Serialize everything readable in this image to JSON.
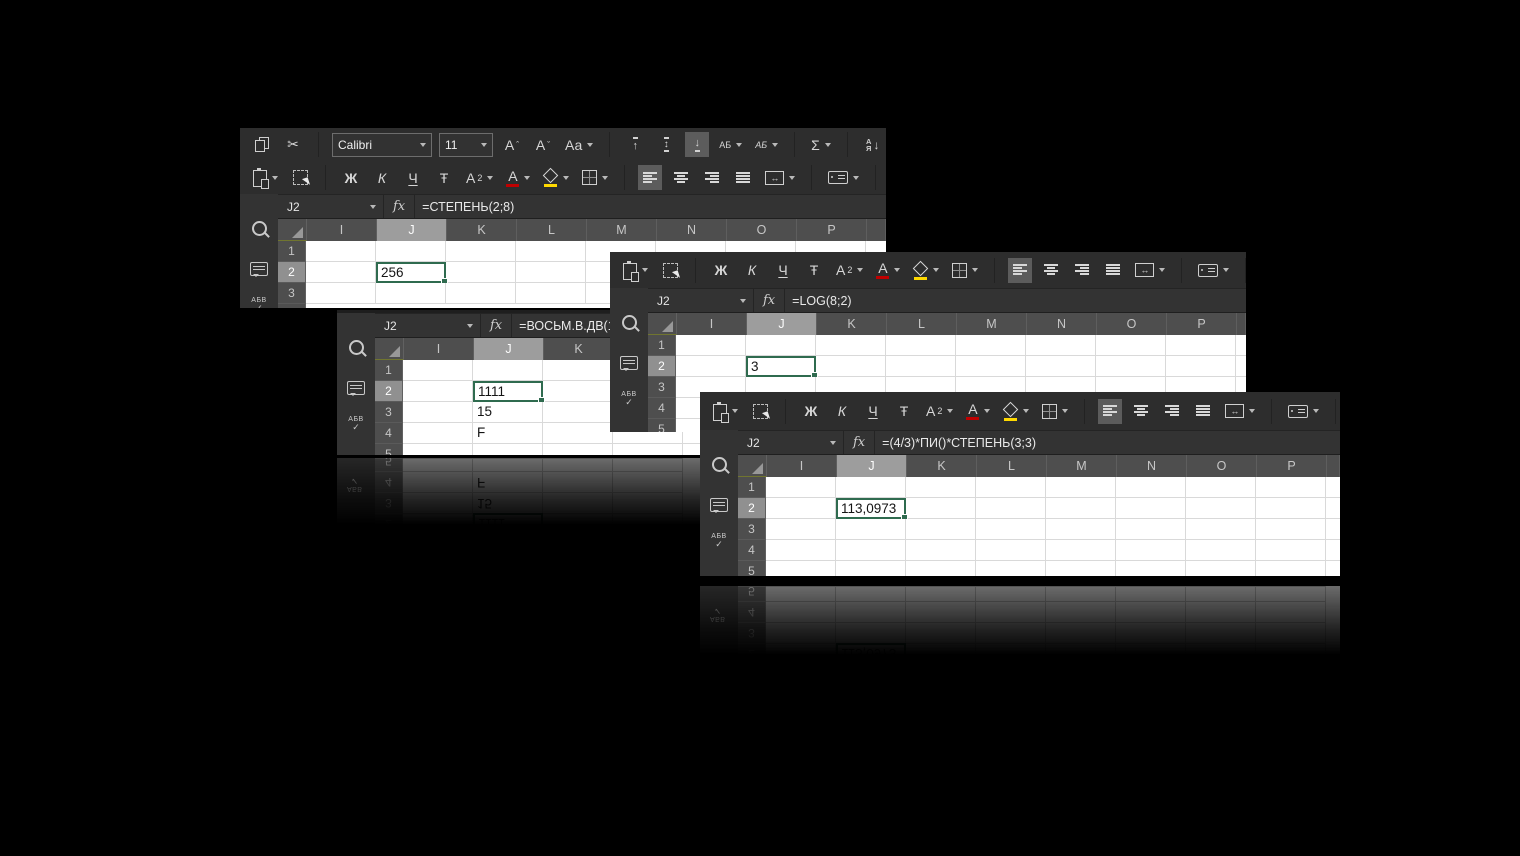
{
  "page": {
    "background": "#000000"
  },
  "colors": {
    "selection_green": "#2f6b4f",
    "font_color_underbar": "#c00000",
    "fill_color_underbar": "#ffd900"
  },
  "sidebar": {
    "spell_label": "АБВ",
    "check_glyph": "✓"
  },
  "formula_bar": {
    "fx": "fx"
  },
  "ribbon": {
    "font_name": "Calibri",
    "font_size": "11",
    "number_format": "Общ",
    "cut_glyph": "✂",
    "bold": "Ж",
    "italic": "К",
    "underline": "Ч",
    "strikethrough": "Ŧ",
    "letter_a": "А",
    "sub_two": "2",
    "case_label": "Аа",
    "caret_up": "ˆ",
    "caret_down": "ˇ",
    "arrow_up": "↑",
    "arrow_down": "↓",
    "arrow_updown": "↕",
    "arrow_leftright": "↔",
    "rotate_label": "АБ",
    "pencil_label": "АБ",
    "sum_glyph": "Σ",
    "percent": "%",
    "sort_a": "А",
    "sort_z": "Я"
  },
  "windows": {
    "w1": {
      "name_box": "J2",
      "formula": "=СТЕПЕНЬ(2;8)",
      "columns": [
        "I",
        "J",
        "K",
        "L",
        "M",
        "N",
        "O",
        "P"
      ],
      "rows": [
        "1",
        "2",
        "3"
      ],
      "value_j2": "256"
    },
    "w2": {
      "name_box": "J2",
      "formula": "=ВОСЬМ.В.ДВ(17)",
      "columns": [
        "I",
        "J",
        "K",
        "L"
      ],
      "rows": [
        "1",
        "2",
        "3",
        "4",
        "5"
      ],
      "value_j2": "1111",
      "value_j3": "15",
      "value_j4": "F"
    },
    "w3": {
      "name_box": "J2",
      "formula": "=LOG(8;2)",
      "columns": [
        "I",
        "J",
        "K",
        "L",
        "M",
        "N",
        "O",
        "P"
      ],
      "rows": [
        "1",
        "2",
        "3",
        "4",
        "5"
      ],
      "value_j2": "3"
    },
    "w4": {
      "name_box": "J2",
      "formula": "=(4/3)*ПИ()*СТЕПЕНЬ(3;3)",
      "columns": [
        "I",
        "J",
        "K",
        "L",
        "M",
        "N",
        "O",
        "P"
      ],
      "rows": [
        "1",
        "2",
        "3",
        "4",
        "5"
      ],
      "value_j2": "113,0973"
    }
  }
}
